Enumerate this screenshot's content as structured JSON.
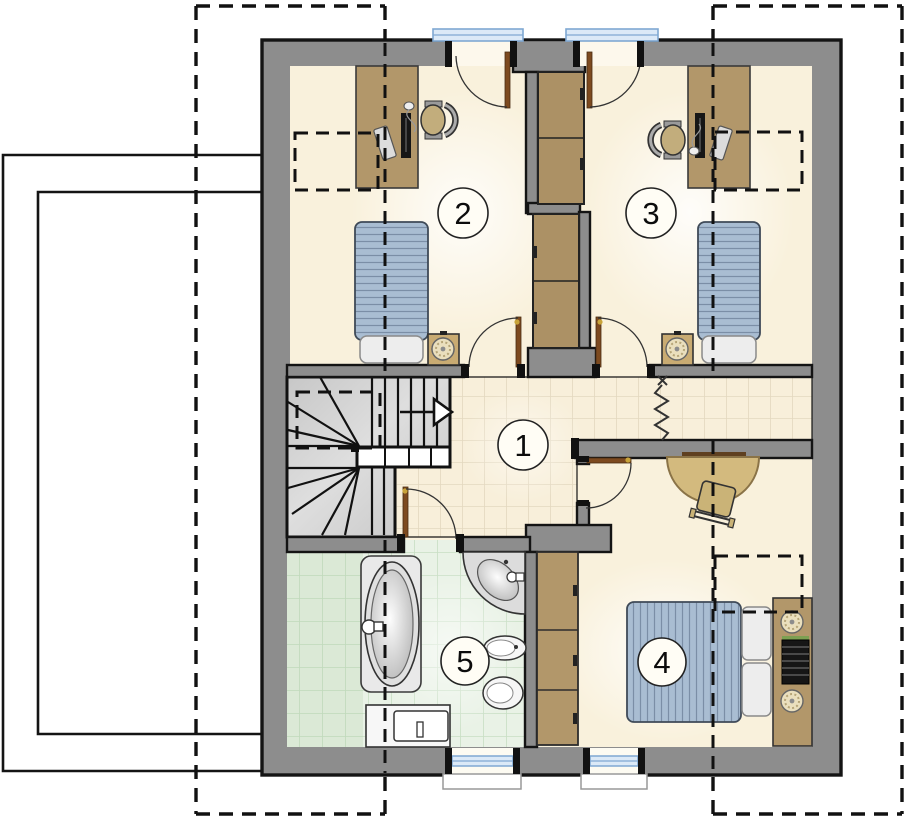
{
  "floorplan": {
    "rooms": [
      {
        "number": "1",
        "name": "hall-landing"
      },
      {
        "number": "2",
        "name": "bedroom-left",
        "furniture": [
          "desk",
          "computer",
          "office-chair",
          "single-bed",
          "nightstand-lamp",
          "wardrobe"
        ]
      },
      {
        "number": "3",
        "name": "bedroom-right",
        "furniture": [
          "desk",
          "computer",
          "office-chair",
          "single-bed",
          "nightstand-lamp",
          "wardrobe"
        ]
      },
      {
        "number": "4",
        "name": "bedroom-bottom",
        "furniture": [
          "double-bed",
          "pillows",
          "headboard-lamps",
          "radiator",
          "wardrobe",
          "half-round-table",
          "chair"
        ]
      },
      {
        "number": "5",
        "name": "bathroom",
        "furniture": [
          "bathtub",
          "corner-sink",
          "bidet",
          "toilet",
          "washing-machine"
        ]
      }
    ],
    "colors": {
      "wall": "#8d8d8d",
      "outline": "#141414",
      "floor": "#f9f1dc",
      "hall_tile": "#f8efda",
      "bath_tile": "#e9f2e6",
      "wood": "#b2976a",
      "closet_wood": "#ac9165",
      "table_wood": "#d3ba7e",
      "bed_blanket": "#a9bdd2",
      "glass": "#dbe9f7",
      "door_leaf": "#7d4a1f",
      "stair": "#d6d6d6"
    }
  }
}
